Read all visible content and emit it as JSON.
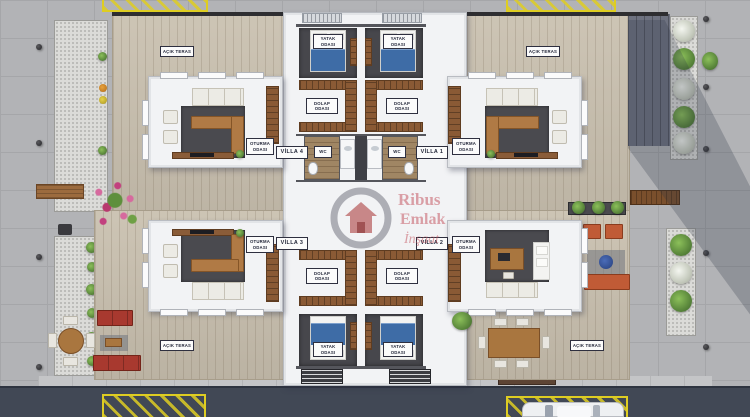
{
  "watermark": {
    "line1": "Ribus",
    "line2": "Emlak",
    "line3": "İnşaat"
  },
  "villas": {
    "v1": "VİLLA 1",
    "v2": "VİLLA 2",
    "v3": "VİLLA 3",
    "v4": "VİLLA 4"
  },
  "rooms": {
    "terrace": "AÇIK TERAS",
    "bedroom": [
      "YATAK",
      "ODASI"
    ],
    "closet": [
      "DOLAP",
      "ODASI"
    ],
    "living": [
      "OTURMA",
      "ODASI"
    ],
    "wc": "WC"
  },
  "colors": {
    "deck_wood": "#c9c0af",
    "asphalt": "#414855",
    "parking_yellow": "#decd22",
    "rug_dark": "#4a4a4f",
    "sofa_brown": "#b07a45",
    "bed_blue": "#3e6ca6",
    "outdoor_sofa_red": "#a8392f",
    "outdoor_sofa_orange": "#c05b36",
    "plant_green": "#6fa045",
    "watermark_pink": "#c45862"
  }
}
